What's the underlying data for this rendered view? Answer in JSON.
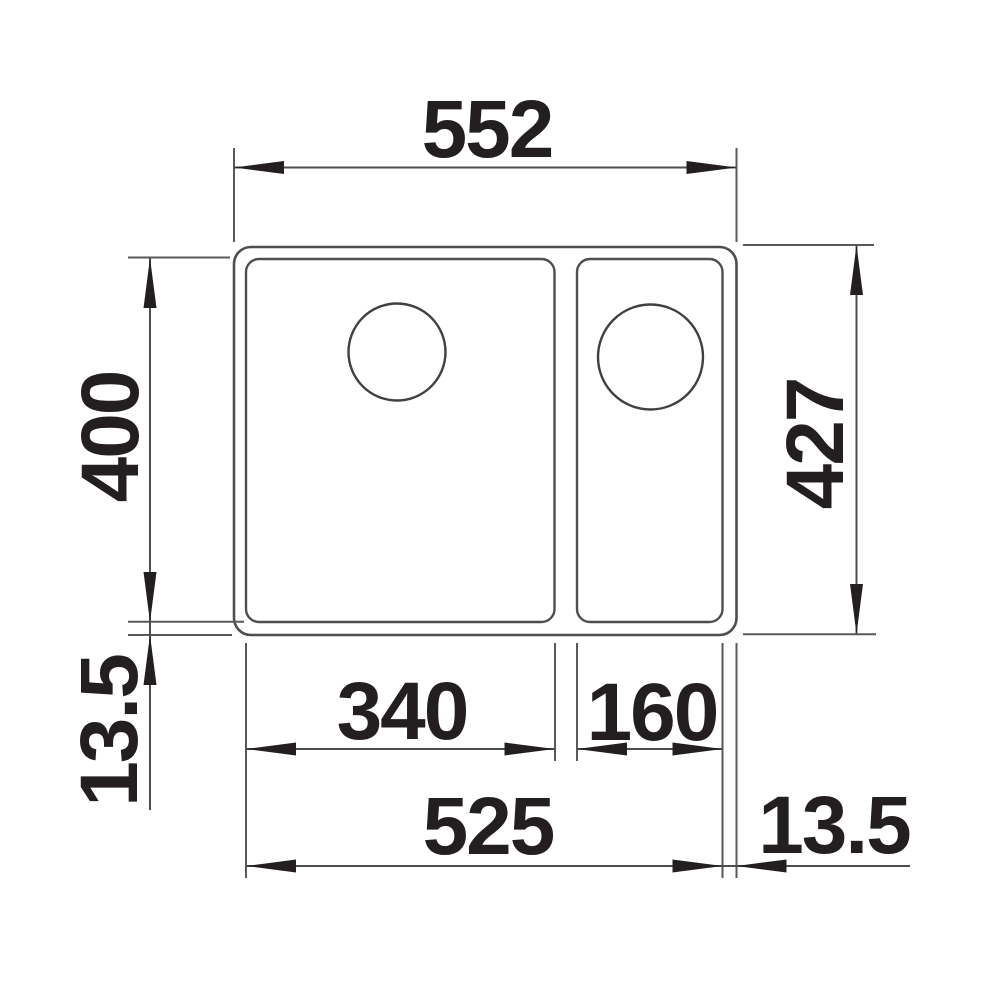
{
  "drawing": {
    "dimensions": {
      "overall_width": "552",
      "overall_depth": "427",
      "bowl_depth": "400",
      "left_rim": "13.5",
      "main_bowl_width": "340",
      "small_bowl_width": "160",
      "inner_width": "525",
      "right_rim": "13.5"
    },
    "colors": {
      "line": "#58595b",
      "outline": "#4d4e50",
      "text": "#231f20",
      "background": "#ffffff"
    }
  }
}
